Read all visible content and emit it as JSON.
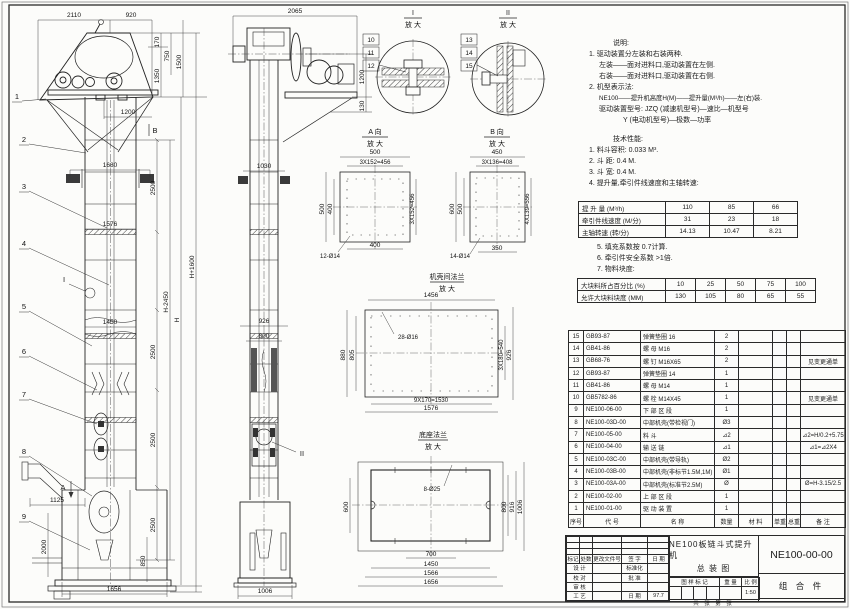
{
  "notes": {
    "heading": "说明:",
    "l1": "1. 驱动装置分左装和右装两种.",
    "l2": "左装——面对进料口,驱动装置在左侧.",
    "l3": "右装——面对进料口,驱动装置在右侧.",
    "l4": "2. 机型表示法:",
    "l5": "NE100——提升机高度H(M)——提升量(M³/h)——左(右)装.",
    "l6": "驱动装置型号: JZQ (减速机型号)—速比—机型号",
    "l7": "Y (电动机型号)—极数—功率"
  },
  "tech": {
    "heading": "技术性能:",
    "l1": "1. 料斗容积: 0.033 M³.",
    "l2": "2. 斗  距: 0.4 M.",
    "l3": "3. 斗  宽: 0.4 M.",
    "l4": "4. 提升量,牵引件线速度和主轴转速:",
    "l5": "5. 填充系数按 0.7计算.",
    "l6": "6. 牵引件安全系数 >1倍.",
    "l7": "7. 物料块度:"
  },
  "cap_table": {
    "r1": {
      "label": "提 升 量  (M³/h)",
      "v1": "110",
      "v2": "85",
      "v3": "66"
    },
    "r2": {
      "label": "牵引件线速度 (M/分)",
      "v1": "31",
      "v2": "23",
      "v3": "18"
    },
    "r3": {
      "label": "主轴转速  (转/分)",
      "v1": "14.13",
      "v2": "10.47",
      "v3": "8.21"
    }
  },
  "lump_table": {
    "r1": {
      "label": "大块料所占百分比 (%)",
      "v": [
        "10",
        "25",
        "50",
        "75",
        "100"
      ]
    },
    "r2": {
      "label": "允许大块料块度 (MM)",
      "v": [
        "130",
        "105",
        "80",
        "65",
        "55"
      ]
    }
  },
  "parts": {
    "h": [
      "序号",
      "代  号",
      "名    称",
      "数量",
      "材  料",
      "单重",
      "总重",
      "备  注"
    ],
    "rows": [
      [
        "15",
        "GB93-87",
        "弹簧垫圈  16",
        "2",
        "",
        "",
        "",
        ""
      ],
      [
        "14",
        "GB41-86",
        "螺 母  M16",
        "2",
        "",
        "",
        "",
        ""
      ],
      [
        "13",
        "GB68-76",
        "螺 钉  M16X65",
        "2",
        "",
        "",
        "",
        "见变更通单"
      ],
      [
        "12",
        "GB93-87",
        "弹簧垫圈  14",
        "1",
        "",
        "",
        "",
        ""
      ],
      [
        "11",
        "GB41-86",
        "螺 母  M14",
        "1",
        "",
        "",
        "",
        ""
      ],
      [
        "10",
        "GB5782-86",
        "螺 栓  M14X45",
        "1",
        "",
        "",
        "",
        "见变更通单"
      ],
      [
        "9",
        "NE100-06-00",
        "下 部 区 段",
        "1",
        "",
        "",
        "",
        ""
      ],
      [
        "8",
        "NE100-03D-00",
        "中部机壳(带检视门)",
        "Ø3",
        "",
        "",
        "",
        ""
      ],
      [
        "7",
        "NE100-05-00",
        "料  斗",
        "⊿2",
        "",
        "",
        "",
        "⊿2=H/0.2+5.75"
      ],
      [
        "6",
        "NE100-04-00",
        "输 送 链",
        "⊿1",
        "",
        "",
        "",
        "⊿1=⊿2X4"
      ],
      [
        "5",
        "NE100-03C-00",
        "中部机壳(带导轨)",
        "Ø2",
        "",
        "",
        "",
        ""
      ],
      [
        "4",
        "NE100-03B-00",
        "中部机壳(非标节1.5M,1M)",
        "Ø1",
        "",
        "",
        "",
        ""
      ],
      [
        "3",
        "NE100-03A-00",
        "中部机壳(标准节2.5M)",
        "Ø",
        "",
        "",
        "",
        "Ø=H-3.15/2.5"
      ],
      [
        "2",
        "NE100-02-00",
        "上 部 区 段",
        "1",
        "",
        "",
        "",
        ""
      ],
      [
        "1",
        "NE100-01-00",
        "驱 动 装 置",
        "1",
        "",
        "",
        "",
        ""
      ]
    ]
  },
  "title_block": {
    "rev_h": [
      "标记",
      "处数",
      "更改文件号",
      "签 字",
      "日 期"
    ],
    "r1a": "设 计",
    "r1b": "标准化",
    "r2a": "校 对",
    "r2b": "批 准",
    "r3a": "审 核",
    "r3b": "",
    "r4a": "工 艺",
    "r4b": "日 期",
    "date": "97.7",
    "name1": "NE100板链斗式提升机",
    "name2": "总  装  图",
    "stamp1": "图 样 标 记",
    "stamp2": "重 量",
    "stamp3": "比 例",
    "scale": "1:50",
    "sheets": "共  张  第  张",
    "dwg_no": "NE100-00-00",
    "kind": "组 合 件"
  },
  "vf": {
    "dims": [
      "2110",
      "920",
      "170",
      "750",
      "1350",
      "1500",
      "1200",
      "1680",
      "2500",
      "1576",
      "2500",
      "1450",
      "2500",
      "1125",
      "2000",
      "2500",
      "850",
      "1656"
    ],
    "hdims": [
      "H-2450",
      "H",
      "H+1600"
    ],
    "balloons": [
      "1",
      "2",
      "3",
      "4",
      "5",
      "6",
      "7",
      "8",
      "9"
    ],
    "marks": [
      "B",
      "I",
      "A"
    ]
  },
  "vs": {
    "dims": [
      "2065",
      "1200",
      "130",
      "1030",
      "926",
      "800",
      "1006"
    ],
    "marks": [
      "II"
    ]
  },
  "dI": {
    "t": "I",
    "mag": "放 大",
    "b": [
      "10",
      "11",
      "12"
    ]
  },
  "dII": {
    "t": "II",
    "mag": "放 大",
    "b": [
      "13",
      "14",
      "15"
    ]
  },
  "dA": {
    "t": "A 向",
    "mag": "放 大",
    "dims": [
      "500",
      "3X152=456",
      "500",
      "400",
      "3X152=456",
      "400"
    ],
    "hole": "12-Ø14"
  },
  "dB": {
    "t": "B 向",
    "mag": "放 大",
    "dims": [
      "450",
      "3X136=408",
      "600",
      "500",
      "4X139=556",
      "350"
    ],
    "hole": "14-Ø14"
  },
  "dF": {
    "t": "机壳间法兰",
    "mag": "放 大",
    "dims": [
      "1456",
      "880",
      "805",
      "3X180=540",
      "926",
      "9X170=1530",
      "1576"
    ],
    "hole": "28-Ø16"
  },
  "dZ": {
    "t": "底座法兰",
    "mag": "放 大",
    "dims": [
      "600",
      "800",
      "916",
      "1006",
      "700",
      "1450",
      "1566",
      "1656"
    ],
    "hole": "8-Ø25"
  }
}
